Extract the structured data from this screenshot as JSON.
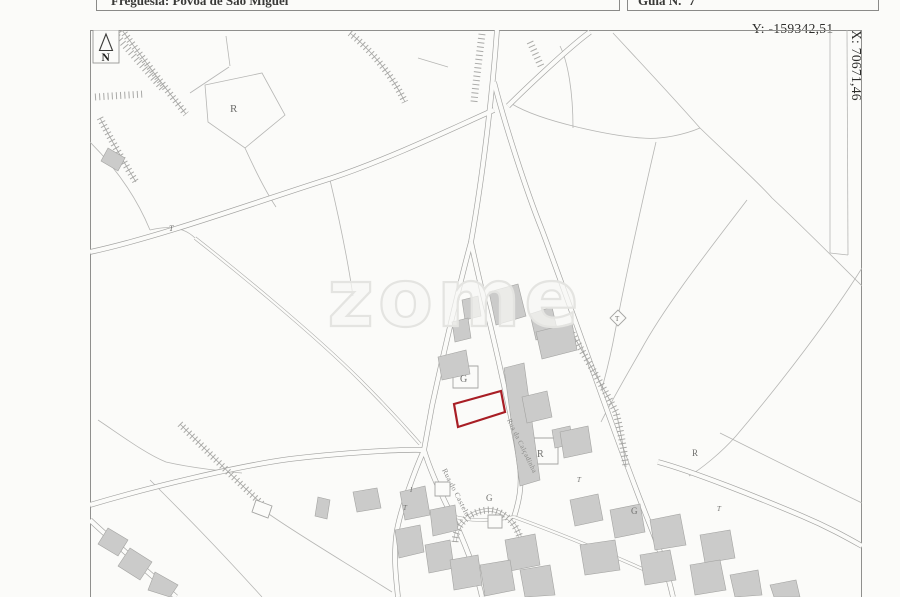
{
  "document": {
    "parish_field": "Freguesia: Póvoa de São Miguel",
    "guide_field": "Guia N.º 7"
  },
  "coordinates": {
    "y_label": "Y: -159342,51",
    "x_label": "X: 70671,46"
  },
  "map": {
    "north_letter": "N",
    "watermark": "zome",
    "streets": [
      "Rua do Castelo",
      "Rua da Calçadinha"
    ],
    "labels": [
      "R",
      "G",
      "R",
      "G",
      "G",
      "R",
      "T",
      "T",
      "T",
      "T",
      "I",
      "T"
    ],
    "colors": {
      "highlight_parcel": "#a81e25",
      "building_fill": "#cbcbca",
      "line": "#a6a6a4"
    }
  }
}
